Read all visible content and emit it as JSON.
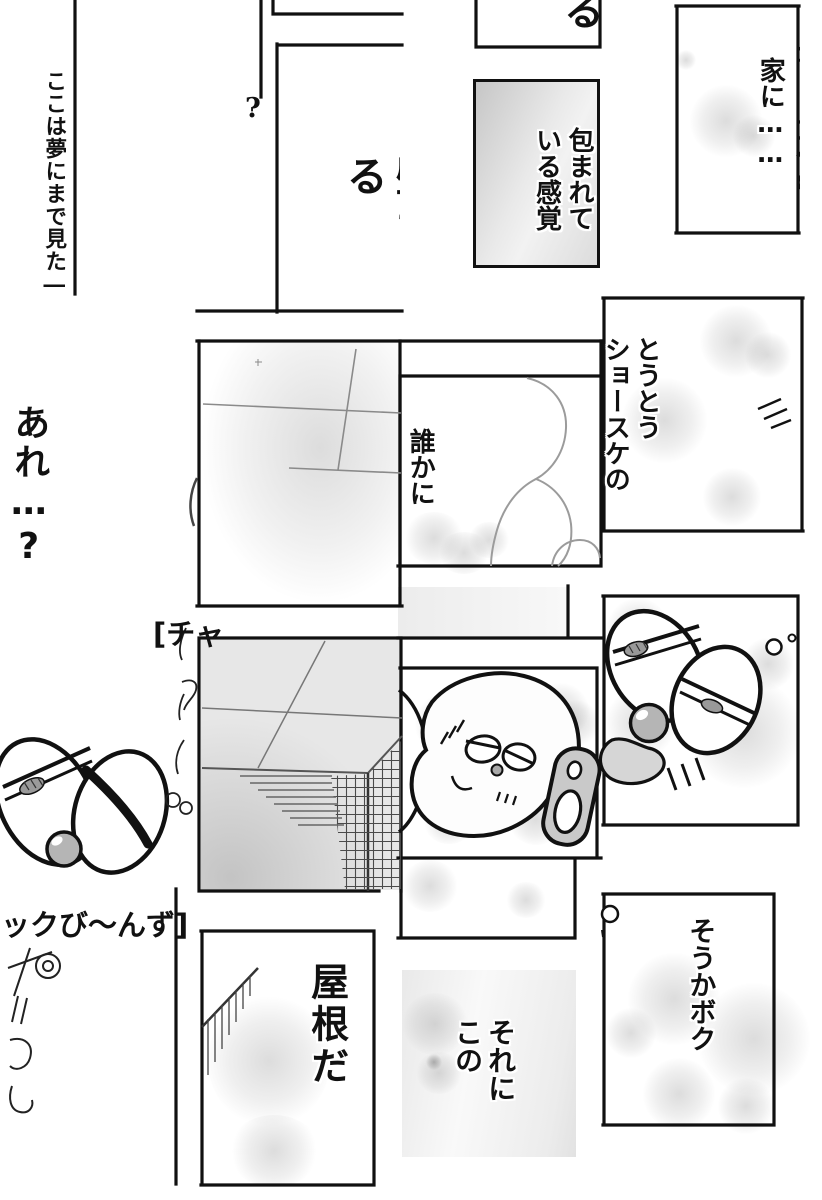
{
  "texts": {
    "dream_caption": "ここは夢にまで見た―",
    "question_mark": "?",
    "wall_dialogue": "壁もある",
    "ru_dialogue": "る",
    "wrapped_feeling": "包まれて\nいる感覚",
    "house_dialogue": "家に……",
    "house_clipped_column": "ショースケの",
    "are_dialogue": "あれ…?",
    "toutou_dialogue": "とうとう\nショースケの",
    "dareka_dialogue": "誰かに",
    "series_title_top": "[チャ",
    "series_title_bottom": "ックび〜んず]",
    "roof_dialogue": "屋根だ",
    "soreni_dialogue": "それに\nこの",
    "souka_dialogue": "そうかボク"
  },
  "colors": {
    "ink": "#111111",
    "panel_gray": "#e7e7e7",
    "tone_gray": "#c9c9c9",
    "nose_gray": "#b5b5b5"
  }
}
